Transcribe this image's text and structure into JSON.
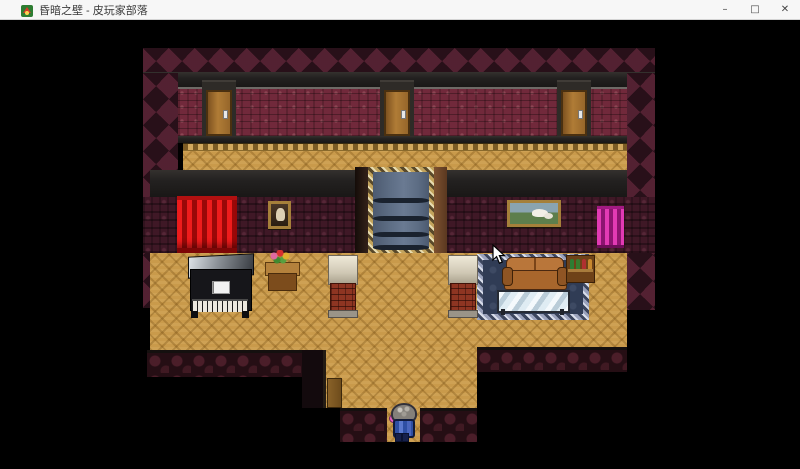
{
  "window": {
    "title": "昏暗之壁 - 皮玩家部落",
    "controls": {
      "minimize": "–",
      "maximize": "□",
      "close": "✕"
    }
  },
  "game": {
    "scene": "top-down RPG interior room (RPG Maker style)",
    "objects": [
      "door-left",
      "door-center",
      "door-right",
      "staircase-with-blue-carpet",
      "red-curtain",
      "magenta-curtain",
      "portrait-painting",
      "landscape-painting",
      "upright-piano",
      "flower-table",
      "brick-pillar-left",
      "brick-pillar-right",
      "ornate-rug",
      "leather-sofa",
      "glass-table",
      "bottle-shelf",
      "wooden-step",
      "player-character"
    ],
    "cursor": {
      "visible": true,
      "approx_x": 493,
      "approx_y": 245
    },
    "colors": {
      "titlebar_bg": "#f7f7f7",
      "titlebar_text": "#3a3a3a",
      "game_bg": "#000000",
      "wall_top": "#31141f",
      "wall_red": "#71293b",
      "wall_dark": "#3f1826",
      "wall_bottom": "#250e14",
      "trim": "#232120",
      "floor": "#c99a4b",
      "door": "#a06a2c",
      "stairs_carpet": "#5d6d84",
      "stairs_trim": "#c2a35c",
      "curtain_red": "#dc1414",
      "curtain_magenta": "#d12ba2",
      "rug": "#303c55",
      "couch": "#b4702f",
      "piano_body": "#16161a",
      "pillar_brick": "#8e3522",
      "character_outfit": "#2e4fa3"
    }
  }
}
